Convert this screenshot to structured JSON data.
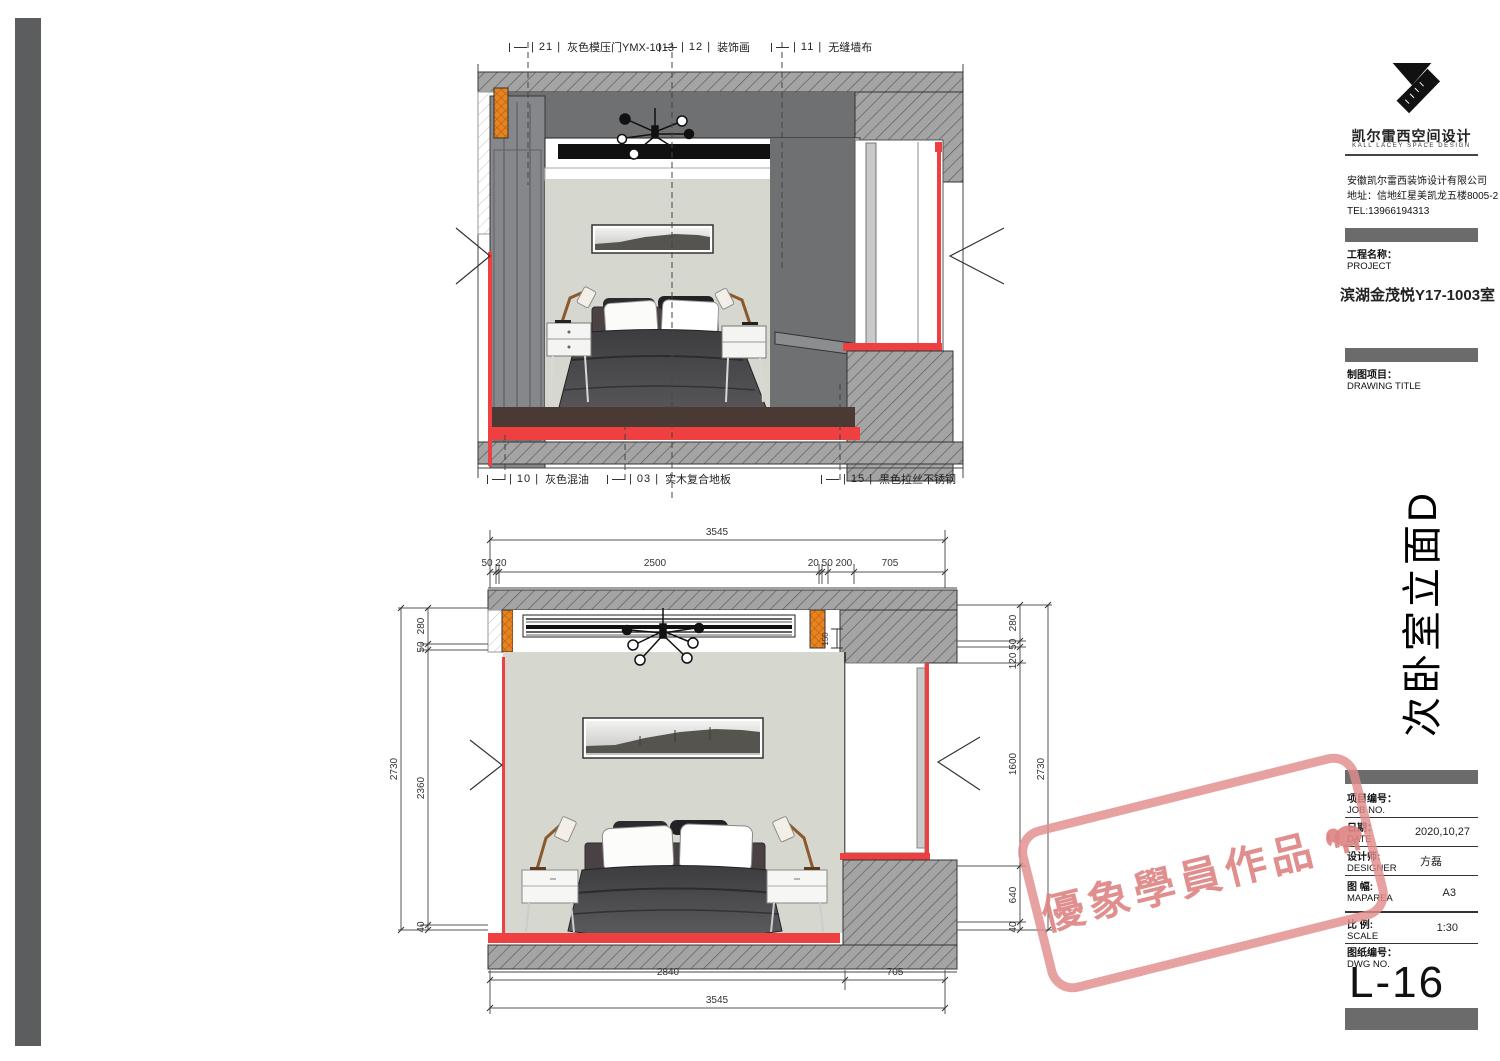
{
  "colors": {
    "accent_red": "#ee4040",
    "accent_orange": "#e8831f",
    "wall_gray": "#d6d8d0",
    "soffit_gray": "#6f7173",
    "hatch_gray": "#a4a4a4",
    "stamp_pink": "#e28c8c",
    "side_bar_gray": "#5b5d5f"
  },
  "brand": {
    "name_cn": "凯尔雷西空间设计",
    "name_en": "KALL LACEY SPACE DESIGN",
    "company": "安徽凯尔雷西装饰设计有限公司",
    "address": "地址：信地红星美凯龙五楼8005-2",
    "tel": "TEL:13966194313"
  },
  "project": {
    "label_cn": "工程名称：",
    "label_en": "PROJECT",
    "name": "滨湖金茂悦Y17-1003室"
  },
  "drawing": {
    "label_cn": "制图项目：",
    "label_en": "DRAWING TITLE",
    "title": "次卧室立面D"
  },
  "fields": {
    "job": {
      "cn": "项目编号：",
      "en": "JOB NO.",
      "value": ""
    },
    "date": {
      "cn": "日期：",
      "en": "DATE",
      "value": "2020,10,27"
    },
    "designer": {
      "cn": "设计师:",
      "en": "DESIGNER",
      "value": "方磊"
    },
    "maparea": {
      "cn": "图 幅:",
      "en": "MAPAREA",
      "value": "A3"
    },
    "scale": {
      "cn": "比 例:",
      "en": "SCALE",
      "value": "1:30"
    },
    "dwg": {
      "cn": "图纸编号：",
      "en": "DWG NO.",
      "value": "L-16"
    }
  },
  "callouts": {
    "c21": {
      "num": "| 21 |",
      "text": "灰色模压门YMX-1013"
    },
    "c12": {
      "num": "| 12 |",
      "text": "装饰画"
    },
    "c11": {
      "num": "| 11 |",
      "text": "无缝墙布"
    },
    "c10": {
      "num": "| 10 |",
      "text": "灰色混油"
    },
    "c03": {
      "num": "| 03 |",
      "text": "实木复合地板"
    },
    "c15": {
      "num": "| 15 |",
      "text": "黑色拉丝不锈钢"
    }
  },
  "dims": {
    "top_total": "3545",
    "seg_a": "50 20",
    "seg_b": "2500",
    "seg_c": "20 50 200",
    "seg_d": "705",
    "bottom_a": "2840",
    "bottom_b": "705",
    "bottom_total": "3545",
    "left_total": "2730",
    "left_a": "280",
    "left_b": "50",
    "left_c": "2360",
    "left_d": "40",
    "right_a": "280",
    "right_b": "120 50",
    "right_c": "1600",
    "right_d": "640",
    "right_e": "40",
    "right_total": "2730",
    "detail": "150"
  },
  "stamp": {
    "text": "優象學員作品"
  }
}
